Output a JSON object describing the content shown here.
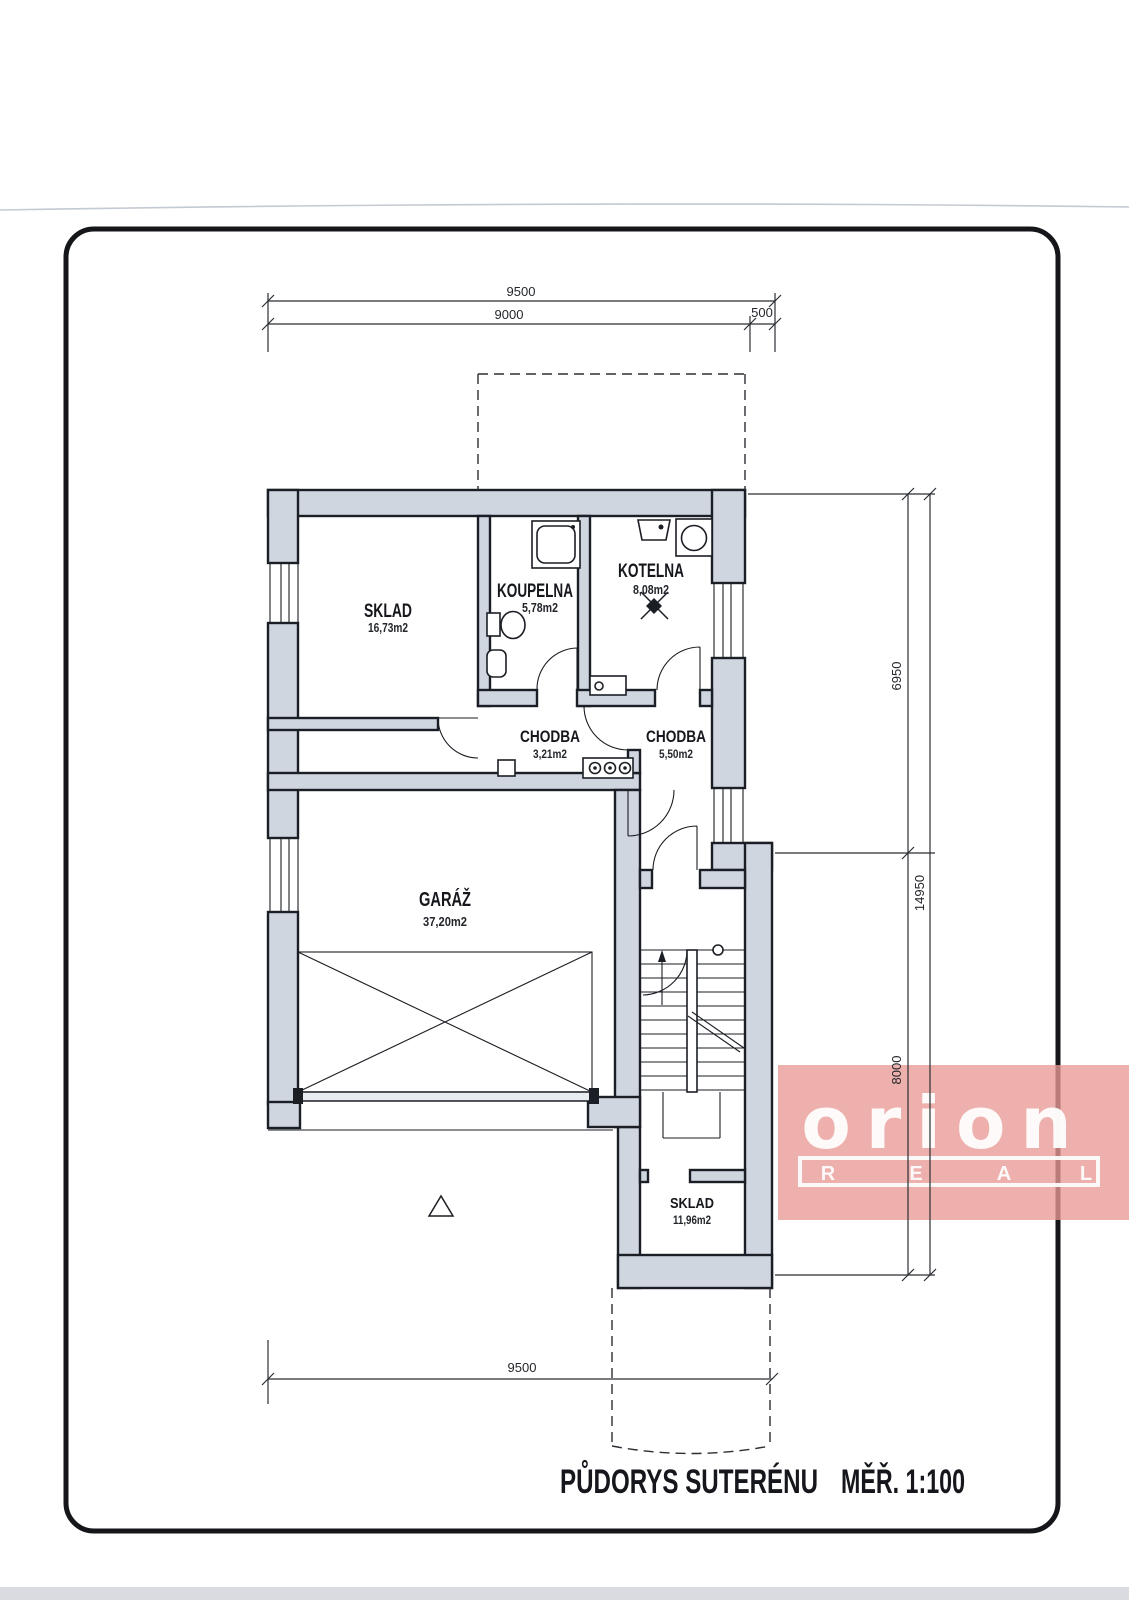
{
  "document": {
    "title": "PŮDORYS SUTERÉNU",
    "scale": "MĚŘ. 1:100"
  },
  "rooms": {
    "sklad_upper": {
      "name": "SKLAD",
      "area": "16,73m2"
    },
    "koupelna": {
      "name": "KOUPELNA",
      "area": "5,78m2"
    },
    "kotelna": {
      "name": "KOTELNA",
      "area": "8,08m2"
    },
    "chodba_small": {
      "name": "CHODBA",
      "area": "3,21m2"
    },
    "chodba_large": {
      "name": "CHODBA",
      "area": "5,50m2"
    },
    "garaz": {
      "name": "GARÁŽ",
      "area": "37,20m2"
    },
    "sklad_lower": {
      "name": "SKLAD",
      "area": "11,96m2"
    }
  },
  "dimensions": {
    "top_total": "9500",
    "top_main": "9000",
    "top_side": "500",
    "right_upper": "6950",
    "right_lower": "8000",
    "right_total": "14950",
    "bottom_total": "9500"
  },
  "watermark": {
    "brand": "orion",
    "letters": [
      "R",
      "E",
      "A",
      "L"
    ]
  },
  "colors": {
    "wall_fill": "#cfd6e0",
    "line": "#1b1e24",
    "watermark_bg": "#e89a95",
    "watermark_text": "#ffffff",
    "paper": "#ffffff"
  }
}
